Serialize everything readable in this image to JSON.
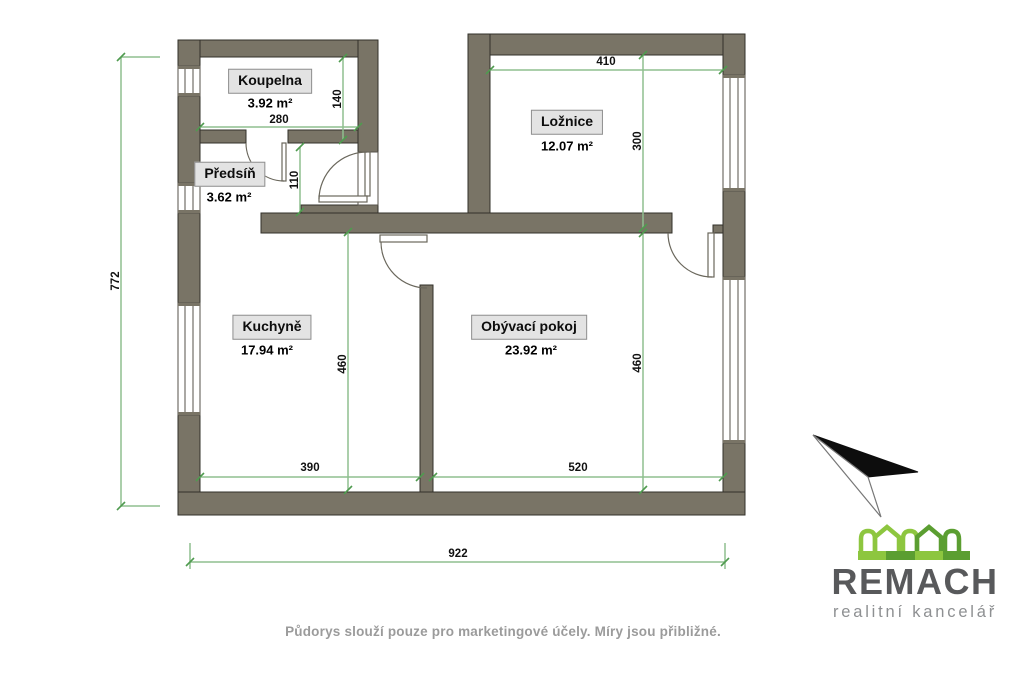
{
  "plan": {
    "rooms": [
      {
        "name": "Koupelna",
        "area": "3.92 m²"
      },
      {
        "name": "Předsíň",
        "area": "3.62 m²"
      },
      {
        "name": "Ložnice",
        "area": "12.07 m²"
      },
      {
        "name": "Kuchyně",
        "area": "17.94 m²"
      },
      {
        "name": "Obývací pokoj",
        "area": "23.92 m²"
      }
    ],
    "dimensions": {
      "koupelna_width": "280",
      "koupelna_depth": "140",
      "hall_door": "110",
      "loznice_width": "410",
      "loznice_depth": "300",
      "left_total": "772",
      "kuchyne_width": "390",
      "kuchyne_depth": "460",
      "obyvaci_width": "520",
      "obyvaci_depth": "460",
      "bottom_total": "922"
    }
  },
  "footer": {
    "disclaimer": "Půdorys slouží pouze pro marketingové účely. Míry jsou přibližné."
  },
  "branding": {
    "name": "REMACH",
    "tagline": "realitní kancelář"
  },
  "colors": {
    "wall": "#797466",
    "dimension_line": "#8fbf8f",
    "dimension_tick": "#4f9b4f",
    "brand_green_light": "#8dc63f",
    "brand_green_dark": "#5b9e31",
    "brand_gray": "#58595b"
  }
}
